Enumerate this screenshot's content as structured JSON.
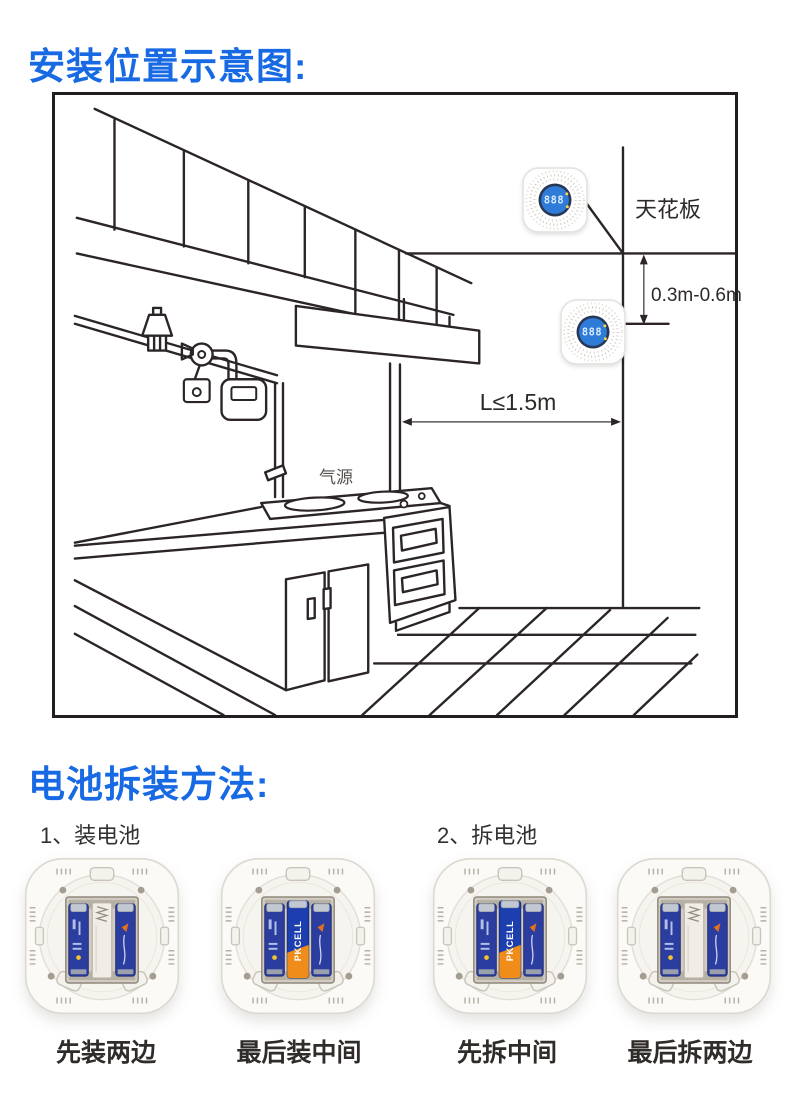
{
  "section1": {
    "title": "安装位置示意图:",
    "diagram": {
      "ceiling_label": "天花板",
      "vertical_distance": "0.3m-0.6m",
      "horizontal_distance": "L≤1.5m",
      "gas_source_label": "气源",
      "detector_display": "888"
    }
  },
  "section2": {
    "title": "电池拆装方法:",
    "steps": [
      {
        "text": "1、装电池"
      },
      {
        "text": "2、拆电池"
      }
    ],
    "battery_brand": "PKCELL",
    "devices": [
      {
        "caption": "先装两边",
        "middle_battery": "empty"
      },
      {
        "caption": "最后装中间",
        "middle_battery": "installed"
      },
      {
        "caption": "先拆中间",
        "middle_battery": "installed"
      },
      {
        "caption": "最后拆两边",
        "middle_battery": "empty"
      }
    ]
  },
  "colors": {
    "accent_blue": "#176ae3",
    "line_black": "#2b2526",
    "battery_blue": "#2c3da0",
    "battery_orange": "#ef8c1a"
  }
}
